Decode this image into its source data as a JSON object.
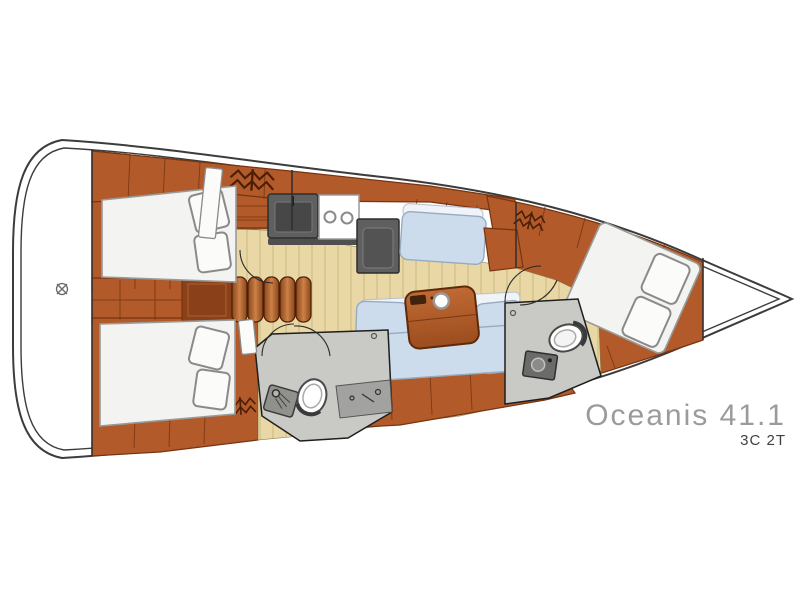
{
  "branding": {
    "model_name": "Oceanis 41.1",
    "layout_code": "3C 2T"
  },
  "colors": {
    "hull-outline": "#3c3c3c",
    "wood": "#b25a2a",
    "wood-dark": "#76340f",
    "wood-deep": "#8a4018",
    "floor": "#e9d8a6",
    "plank": "#a8904f",
    "settee": "#ccdcec",
    "settee-edge": "#96abc0",
    "cushion-white": "#f0f3f7",
    "bed": "#f3f3f1",
    "pillow": "#fbfbf9",
    "bed-edge": "#9a9a98",
    "room-gray": "#c9c9c6",
    "counter-dark": "#5f5f5f",
    "counter-mid": "#a2a2a0",
    "text-title": "#9b9b9b",
    "text-sub": "#3f3f3f"
  },
  "icons": {
    "hanging_locker": "zigzag-hangers",
    "deck_fitting": "circle-cross",
    "stove": "two-burners",
    "galley_sink": "basin-with-faucet",
    "toilet": "wc-bowl",
    "shower": "showerhead",
    "table_cupholder": "white-ring"
  }
}
